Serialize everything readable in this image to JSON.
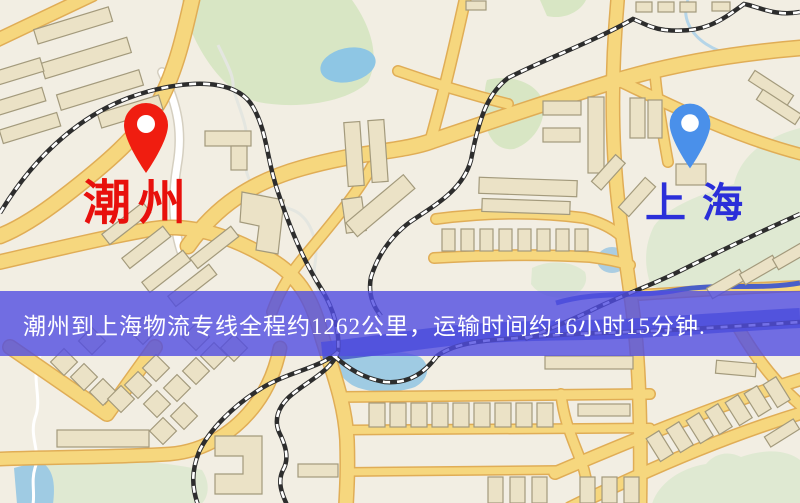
{
  "map": {
    "origin": {
      "name": "潮州",
      "pin_color": "#f01d10",
      "label_color": "#e8100c"
    },
    "destination": {
      "name": "上海",
      "pin_color": "#4a90ea",
      "label_color": "#2b2fd9"
    },
    "banner": {
      "text": "潮州到上海物流专线全程约1262公里，运输时间约16小时15分钟.",
      "background_color": "rgba(80,76,225,0.8)",
      "text_color": "#ffffff"
    },
    "route_summary": {
      "origin": "潮州",
      "destination": "上海",
      "distance": "约1262公里",
      "duration": "约16小时15分钟"
    },
    "palette": {
      "background": "#f2eee3",
      "road": "#f6d77e",
      "road_casing": "#e0ad56",
      "building": "#ebe2c6",
      "building_outline": "#a39a7c",
      "park_green": "#d8e6c4",
      "water_blue": "#9fcbe3",
      "river_blue": "#4a5fc8",
      "railway": "#2d2d2d"
    }
  }
}
